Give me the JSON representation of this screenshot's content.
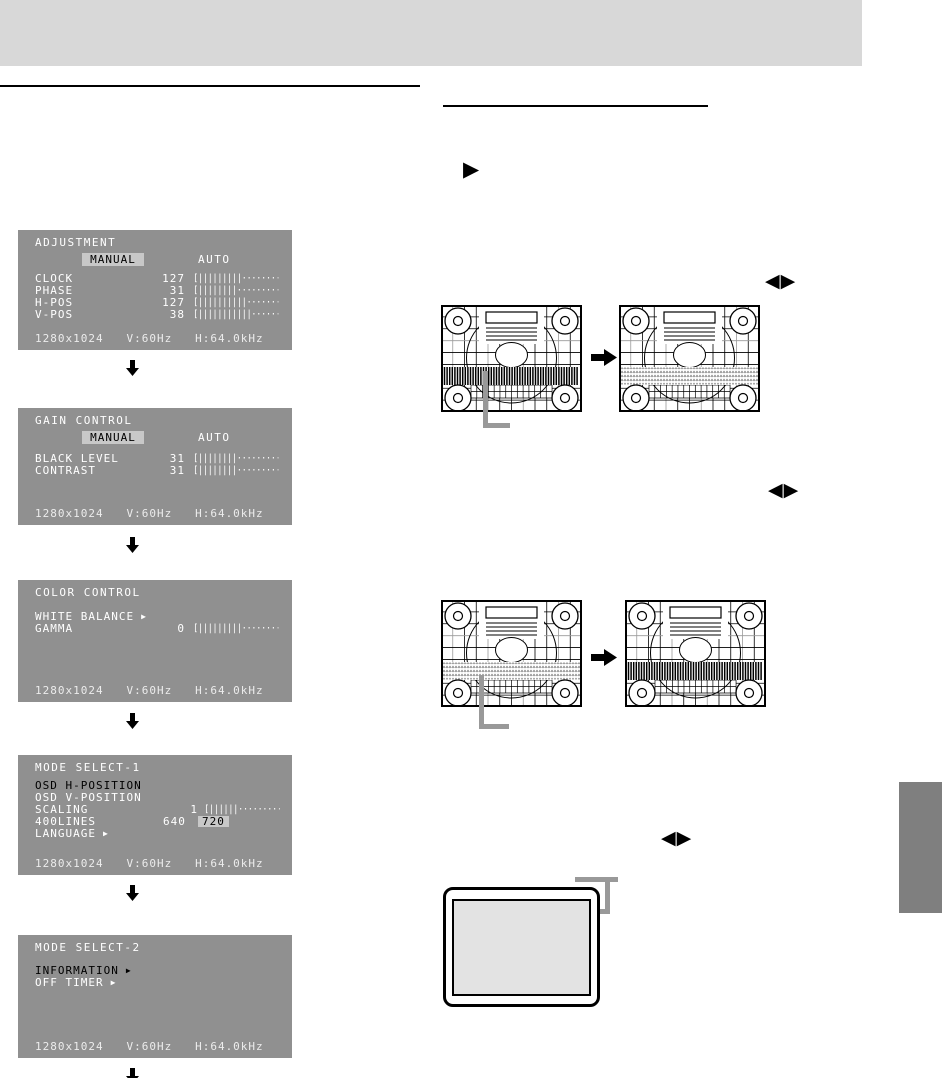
{
  "glyphs": {
    "left_right_adjust": "◀▶",
    "select_pointer": "▶"
  },
  "colors": {
    "banner": "#d8d8d8",
    "osd_background": "#909090",
    "osd_highlight": "#c8c8c8",
    "osd_text": "#ffffff",
    "osd_selected_text": "#000000",
    "callout_gray": "#999999",
    "section_tab": "#7f7f7f",
    "monitor_screen": "#e3e3e3"
  },
  "osd_screens": [
    {
      "title": "ADJUSTMENT",
      "mode": {
        "selected": "MANUAL",
        "alternative": "AUTO"
      },
      "rows": [
        {
          "label": "CLOCK",
          "value": "127",
          "bar": {
            "filled": 9,
            "dots": 9
          }
        },
        {
          "label": "PHASE",
          "value": "31",
          "bar": {
            "filled": 8,
            "dots": 9
          }
        },
        {
          "label": "H-POS",
          "value": "127",
          "bar": {
            "filled": 10,
            "dots": 9
          }
        },
        {
          "label": "V-POS",
          "value": "38",
          "bar": {
            "filled": 11,
            "dots": 7
          }
        }
      ],
      "status": "1280x1024   V:60Hz   H:64.0kHz"
    },
    {
      "title": "GAIN CONTROL",
      "mode": {
        "selected": "MANUAL",
        "alternative": "AUTO"
      },
      "rows": [
        {
          "label": "BLACK LEVEL",
          "value": "31",
          "bar": {
            "filled": 8,
            "dots": 10
          }
        },
        {
          "label": "CONTRAST",
          "value": "31",
          "bar": {
            "filled": 8,
            "dots": 10
          }
        }
      ],
      "status": "1280x1024   V:60Hz   H:64.0kHz"
    },
    {
      "title": "COLOR CONTROL",
      "rows": [
        {
          "label": "WHITE BALANCE",
          "arrow": true
        },
        {
          "label": "GAMMA",
          "value": "0",
          "bar": {
            "filled": 9,
            "dots": 9
          }
        }
      ],
      "status": "1280x1024   V:60Hz   H:64.0kHz"
    },
    {
      "title": "MODE SELECT-1",
      "rows": [
        {
          "label": "OSD H-POSITION",
          "selected": true
        },
        {
          "label": "OSD V-POSITION"
        },
        {
          "label": "SCALING",
          "value": "1",
          "small_bar": true,
          "bar": {
            "filled": 6,
            "dots": 9
          }
        },
        {
          "label": "400LINES",
          "options": [
            {
              "text": "640"
            },
            {
              "text": "720",
              "highlighted": true
            }
          ]
        },
        {
          "label": "LANGUAGE",
          "arrow": true
        }
      ],
      "status": "1280x1024   V:60Hz   H:64.0kHz"
    },
    {
      "title": "MODE SELECT-2",
      "rows": [
        {
          "label": "INFORMATION",
          "arrow": true,
          "selected": true
        },
        {
          "label": "OFF TIMER",
          "arrow": true
        }
      ],
      "status": "1280x1024   V:60Hz   H:64.0kHz"
    }
  ],
  "figures": {
    "pairs": [
      {
        "before_band": "stripes-dark",
        "after_band": "noise-light"
      },
      {
        "before_band": "noise-light",
        "after_band": "stripes-dark"
      }
    ]
  }
}
